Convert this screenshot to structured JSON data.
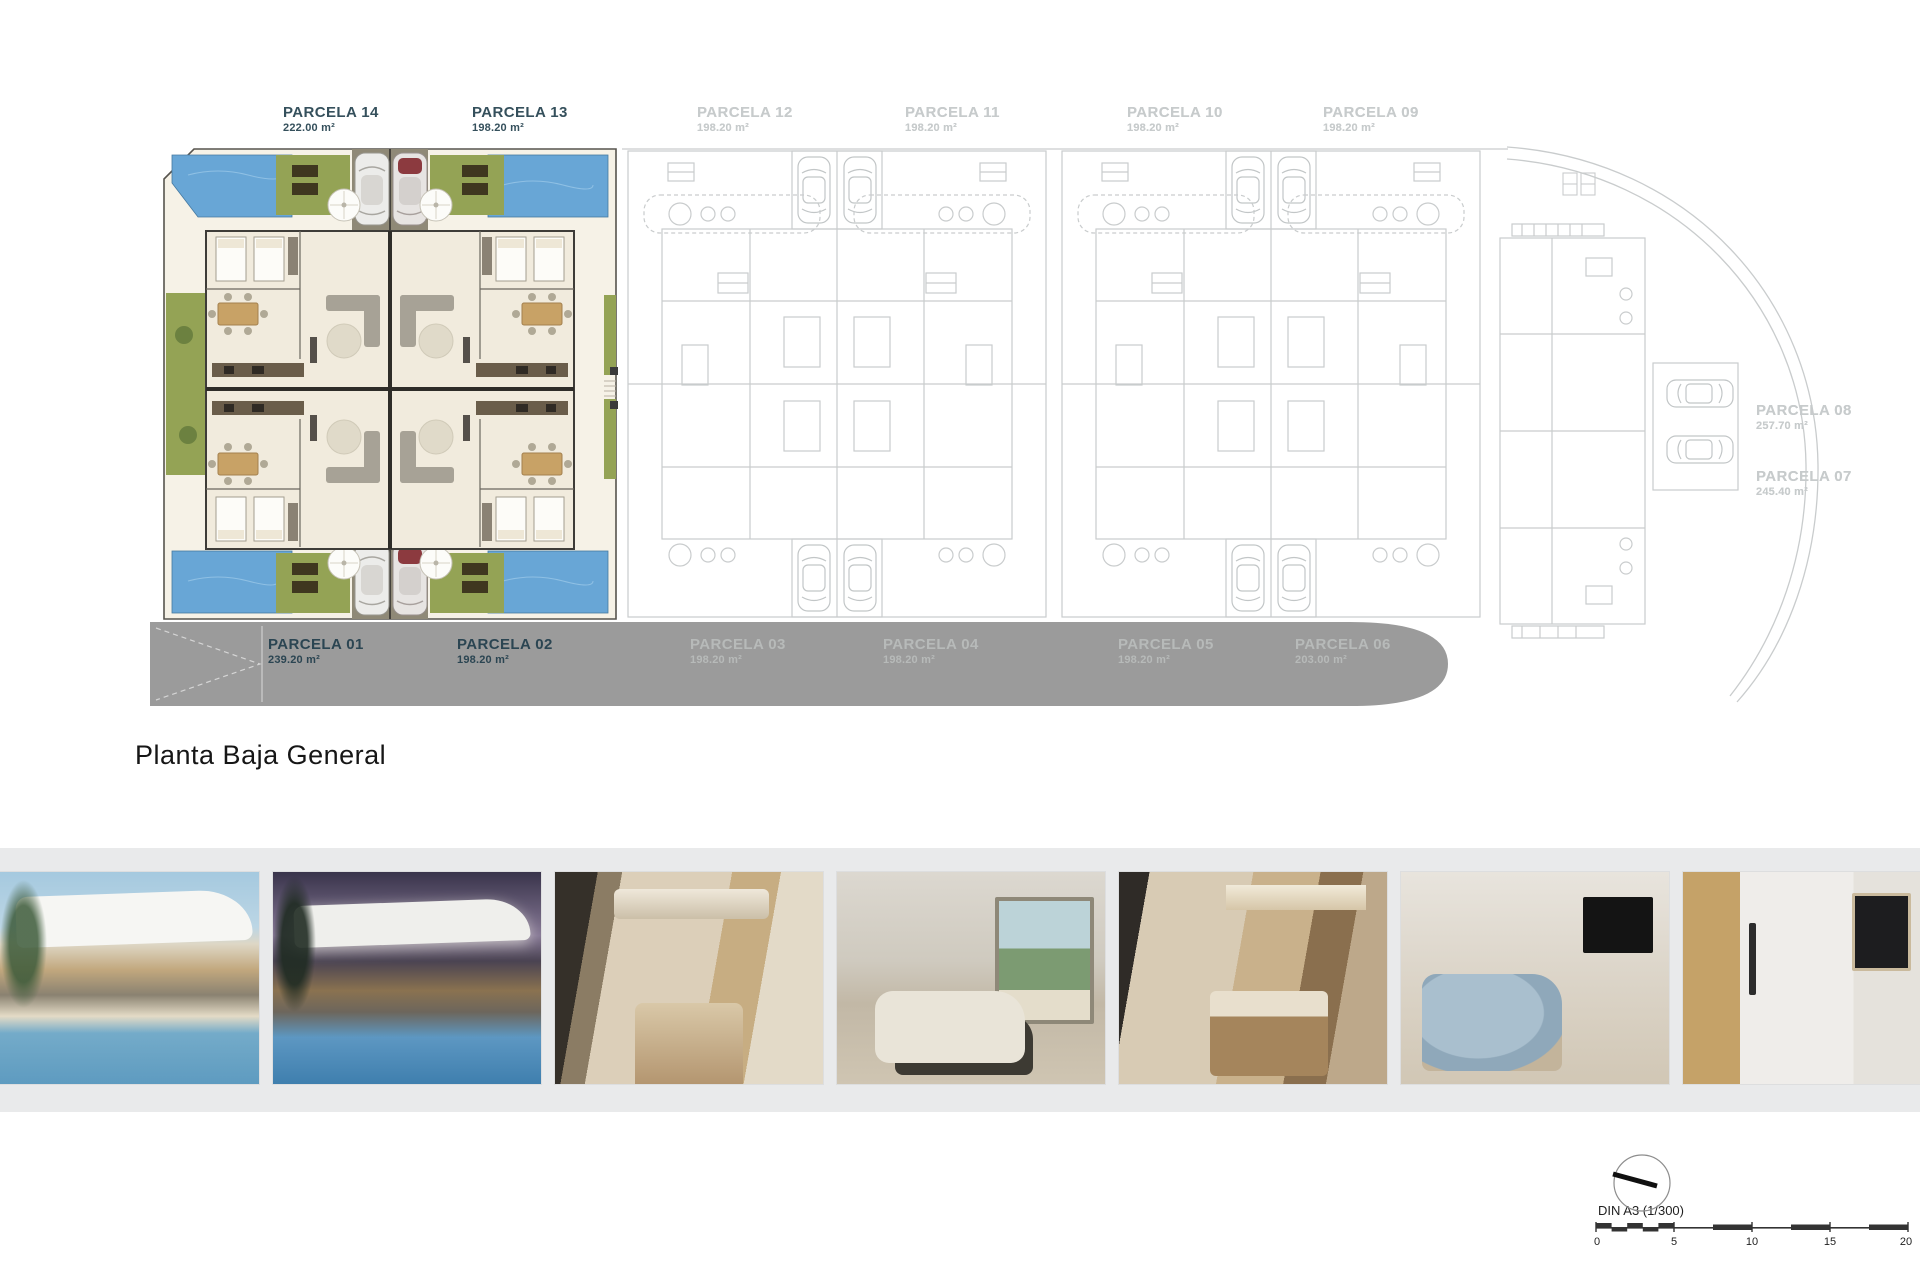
{
  "page": {
    "title": "Planta Baja General"
  },
  "parcels": {
    "top": [
      {
        "name": "PARCELA 14",
        "area": "222.00 m²",
        "state": "active"
      },
      {
        "name": "PARCELA 13",
        "area": "198.20 m²",
        "state": "active"
      },
      {
        "name": "PARCELA 12",
        "area": "198.20 m²",
        "state": "ghost"
      },
      {
        "name": "PARCELA 11",
        "area": "198.20 m²",
        "state": "ghost"
      },
      {
        "name": "PARCELA 10",
        "area": "198.20 m²",
        "state": "ghost"
      },
      {
        "name": "PARCELA 09",
        "area": "198.20 m²",
        "state": "ghost"
      }
    ],
    "right": [
      {
        "name": "PARCELA 08",
        "area": "257.70 m²",
        "state": "ghost"
      },
      {
        "name": "PARCELA 07",
        "area": "245.40 m²",
        "state": "ghost"
      }
    ],
    "road": [
      {
        "name": "PARCELA 01",
        "area": "239.20 m²",
        "state": "active"
      },
      {
        "name": "PARCELA 02",
        "area": "198.20 m²",
        "state": "active"
      },
      {
        "name": "PARCELA 03",
        "area": "198.20 m²",
        "state": "ghost"
      },
      {
        "name": "PARCELA 04",
        "area": "198.20 m²",
        "state": "ghost"
      },
      {
        "name": "PARCELA 05",
        "area": "198.20 m²",
        "state": "ghost"
      },
      {
        "name": "PARCELA 06",
        "area": "203.00 m²",
        "state": "ghost"
      }
    ]
  },
  "scale": {
    "format_label": "DIN A3 (1/300)",
    "ticks": [
      "0",
      "5",
      "10",
      "15",
      "20"
    ]
  },
  "photos": [
    {
      "name": "villa-exterior-day-pool"
    },
    {
      "name": "villa-exterior-dusk-pool"
    },
    {
      "name": "kitchen-dining-interior"
    },
    {
      "name": "living-room-interior"
    },
    {
      "name": "kitchen-island-dining-interior"
    },
    {
      "name": "bedroom-interior"
    },
    {
      "name": "bathroom-shower-interior"
    }
  ],
  "colors": {
    "accent_label": "#35505c",
    "ghost_label": "#c7cbcc",
    "road_gray": "#9b9b9b",
    "pool_blue": "#68a6d6",
    "grass_green": "#94a355",
    "photo_band": "#e9eaeb"
  }
}
